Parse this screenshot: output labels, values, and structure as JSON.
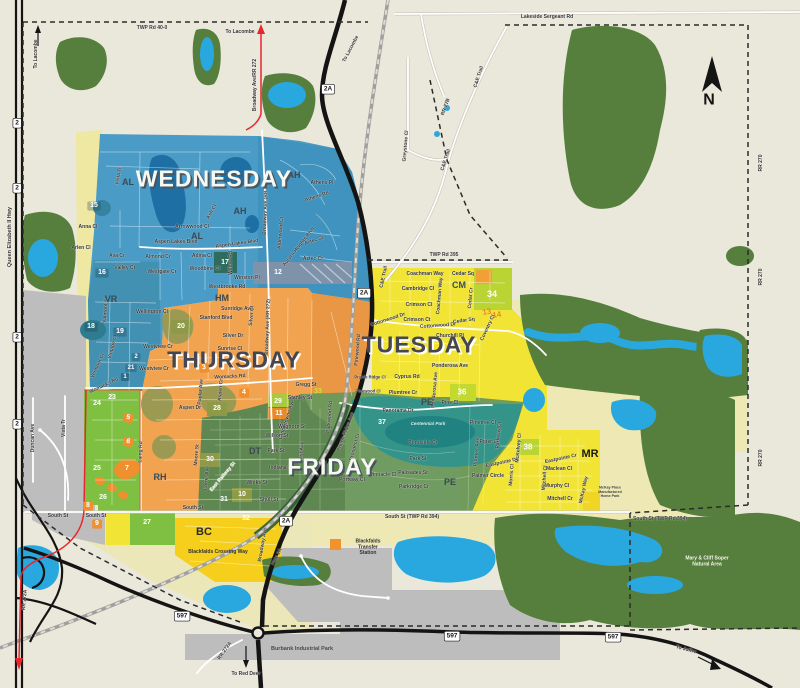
{
  "map": {
    "compass": {
      "label": "N"
    },
    "zone_colors": {
      "background": "#eae7db",
      "wednesday": "#4a9cc6",
      "wednesday_dark": "#3e92bd",
      "thursday": "#f1a350",
      "tuesday": "#f2e434",
      "friday": "#6a985c",
      "friday_dark": "#5a8450",
      "monday_lime": "#7fc043",
      "pale_yellow": "#eee9b4",
      "forest": "#567e3c",
      "water": "#29a8df",
      "gray": "#bdbdbd",
      "park_teal": "#2e948e"
    },
    "days": [
      {
        "t": "WEDNESDAY",
        "x": 214,
        "y": 179,
        "s": 23,
        "c": "#f8f8f2",
        "sh": "#4a5560",
        "fw": 800
      },
      {
        "t": "THURSDAY",
        "x": 234,
        "y": 360,
        "s": 23,
        "c": "#45464f",
        "sh": "#ffffff",
        "fw": 800
      },
      {
        "t": "TUESDAY",
        "x": 419,
        "y": 345,
        "s": 23,
        "c": "#45464f",
        "sh": "#ffffff",
        "fw": 800
      },
      {
        "t": "FRIDAY",
        "x": 332,
        "y": 467,
        "s": 23,
        "c": "#f8f8f2",
        "sh": "#4a5560",
        "fw": 800
      }
    ],
    "areas": [
      {
        "t": "AL",
        "x": 128,
        "y": 183
      },
      {
        "t": "AL",
        "x": 197,
        "y": 237
      },
      {
        "t": "AH",
        "x": 294,
        "y": 176
      },
      {
        "t": "AH",
        "x": 240,
        "y": 212
      },
      {
        "t": "VR",
        "x": 111,
        "y": 300
      },
      {
        "t": "HM",
        "x": 222,
        "y": 299
      },
      {
        "t": "RH",
        "x": 160,
        "y": 478
      },
      {
        "t": "DT",
        "x": 255,
        "y": 452
      },
      {
        "t": "PE",
        "x": 427,
        "y": 403
      },
      {
        "t": "PE",
        "x": 450,
        "y": 483
      },
      {
        "t": "CM",
        "x": 459,
        "y": 286
      },
      {
        "t": "MR",
        "x": 590,
        "y": 455,
        "s": 11,
        "c": "#1a1a1a"
      },
      {
        "t": "BC",
        "x": 204,
        "y": 533,
        "s": 11,
        "c": "#2a2a2a"
      }
    ],
    "shields": [
      {
        "t": "2",
        "x": 17,
        "y": 123
      },
      {
        "t": "2",
        "x": 17,
        "y": 188
      },
      {
        "t": "2",
        "x": 17,
        "y": 337
      },
      {
        "t": "2",
        "x": 17,
        "y": 424
      },
      {
        "t": "2A",
        "x": 328,
        "y": 89
      },
      {
        "t": "2A",
        "x": 364,
        "y": 293
      },
      {
        "t": "2A",
        "x": 286,
        "y": 521
      },
      {
        "t": "597",
        "x": 182,
        "y": 616
      },
      {
        "t": "597",
        "x": 452,
        "y": 636
      },
      {
        "t": "597",
        "x": 613,
        "y": 637
      }
    ],
    "badges": [
      {
        "t": "12",
        "x": 278,
        "y": 273
      },
      {
        "t": "15",
        "x": 94,
        "y": 206,
        "b": "rgba(22,62,84,0.30)"
      },
      {
        "t": "16",
        "x": 102,
        "y": 273,
        "b": "rgba(22,62,84,0.30)"
      },
      {
        "t": "17",
        "x": 225,
        "y": 263
      },
      {
        "t": "18",
        "x": 91,
        "y": 327,
        "b": "rgba(22,62,84,0.30)"
      },
      {
        "t": "19",
        "x": 120,
        "y": 332,
        "b": "rgba(22,62,84,0.30)"
      },
      {
        "t": "20",
        "x": 181,
        "y": 327
      },
      {
        "t": "1",
        "x": 125,
        "y": 377,
        "b": "rgba(22,62,84,0.45)",
        "s": 6
      },
      {
        "t": "2",
        "x": 136,
        "y": 357,
        "b": "rgba(22,62,84,0.30)",
        "s": 6
      },
      {
        "t": "21",
        "x": 131,
        "y": 368,
        "b": "rgba(22,62,84,0.30)",
        "s": 6
      },
      {
        "t": "3",
        "x": 204,
        "y": 368,
        "b": "#ef8f2d",
        "r": -8
      },
      {
        "t": "4",
        "x": 244,
        "y": 393,
        "b": "#ef8f2d"
      },
      {
        "t": "5",
        "x": 128,
        "y": 418,
        "b": "#ef8f2d",
        "r": 14
      },
      {
        "t": "6",
        "x": 128,
        "y": 442,
        "b": "#ef8f2d",
        "r": 14
      },
      {
        "t": "7",
        "x": 127,
        "y": 469
      },
      {
        "t": "8",
        "x": 88,
        "y": 506,
        "b": "#ef8f2d"
      },
      {
        "t": "9",
        "x": 97,
        "y": 524,
        "b": "#ef8f2d"
      },
      {
        "t": "10",
        "x": 242,
        "y": 495
      },
      {
        "t": "11",
        "x": 279,
        "y": 414
      },
      {
        "t": "13",
        "x": 487,
        "y": 313,
        "c": "#e8872e",
        "r": -10,
        "s": 8
      },
      {
        "t": "14",
        "x": 497,
        "y": 316,
        "c": "#e8872e",
        "r": -10,
        "s": 8
      },
      {
        "t": "23",
        "x": 112,
        "y": 398
      },
      {
        "t": "24",
        "x": 97,
        "y": 404
      },
      {
        "t": "25",
        "x": 97,
        "y": 469
      },
      {
        "t": "26",
        "x": 103,
        "y": 498
      },
      {
        "t": "27",
        "x": 147,
        "y": 523
      },
      {
        "t": "28",
        "x": 217,
        "y": 409
      },
      {
        "t": "29",
        "x": 278,
        "y": 402
      },
      {
        "t": "30",
        "x": 210,
        "y": 460
      },
      {
        "t": "31",
        "x": 224,
        "y": 500
      },
      {
        "t": "32",
        "x": 246,
        "y": 519
      },
      {
        "t": "33",
        "x": 318,
        "y": 392,
        "c": "#cde23f"
      },
      {
        "t": "34",
        "x": 492,
        "y": 295,
        "s": 9
      },
      {
        "t": "36",
        "x": 462,
        "y": 393,
        "s": 8
      },
      {
        "t": "37",
        "x": 382,
        "y": 423
      },
      {
        "t": "38",
        "x": 528,
        "y": 448,
        "s": 8
      }
    ],
    "roads": [
      {
        "t": "TWP Rd 40-0",
        "x": 152,
        "y": 28
      },
      {
        "t": "Lakeside Sergeant Rd",
        "x": 547,
        "y": 17
      },
      {
        "t": "To Lacombe",
        "x": 36,
        "y": 54,
        "r": -90,
        "fw": 700
      },
      {
        "t": "To Lacombe",
        "x": 240,
        "y": 32,
        "fw": 700
      },
      {
        "t": "To Lacombe",
        "x": 351,
        "y": 49,
        "r": -62,
        "fw": 700
      },
      {
        "t": "Broadway Ave/RR 272",
        "x": 255,
        "y": 85,
        "r": -90
      },
      {
        "t": "Queen Elizabeth II Hwy",
        "x": 10,
        "y": 237,
        "r": -90,
        "s": 5.5
      },
      {
        "t": "RR 270",
        "x": 761,
        "y": 163,
        "r": -90
      },
      {
        "t": "RR 270",
        "x": 761,
        "y": 277,
        "r": -90
      },
      {
        "t": "RR 270",
        "x": 761,
        "y": 458,
        "r": -90
      },
      {
        "t": "RR 27B",
        "x": 446,
        "y": 107,
        "r": -70
      },
      {
        "t": "Greystone Cl",
        "x": 406,
        "y": 146,
        "r": -85
      },
      {
        "t": "C&E Trail",
        "x": 479,
        "y": 77,
        "r": -72
      },
      {
        "t": "C&E Trail",
        "x": 446,
        "y": 160,
        "r": -72
      },
      {
        "t": "C&E Trail",
        "x": 384,
        "y": 277,
        "r": -78
      },
      {
        "t": "TWP Rd 395",
        "x": 444,
        "y": 255
      },
      {
        "t": "South St (TWP Rd 394)",
        "x": 412,
        "y": 517
      },
      {
        "t": "South St (TWP Rd 394)",
        "x": 660,
        "y": 519
      },
      {
        "t": "South St",
        "x": 58,
        "y": 516
      },
      {
        "t": "South St",
        "x": 96,
        "y": 516
      },
      {
        "t": "South St",
        "x": 193,
        "y": 508
      },
      {
        "t": "Womacks Rd",
        "x": 230,
        "y": 377,
        "r": -3
      },
      {
        "t": "Womacks Rd",
        "x": 104,
        "y": 386,
        "r": -25
      },
      {
        "t": "Duncan Ave",
        "x": 33,
        "y": 438,
        "r": -90
      },
      {
        "t": "Vista Tr",
        "x": 64,
        "y": 428,
        "r": -90
      },
      {
        "t": "Vista Tr",
        "x": 119,
        "y": 176,
        "r": -80
      },
      {
        "t": "Anna Cl",
        "x": 88,
        "y": 227
      },
      {
        "t": "Arlen Cl",
        "x": 81,
        "y": 248
      },
      {
        "t": "Ava Cr",
        "x": 117,
        "y": 256
      },
      {
        "t": "Valley Cr",
        "x": 125,
        "y": 268
      },
      {
        "t": "Aspen Lakes Blvd",
        "x": 176,
        "y": 242
      },
      {
        "t": "Aspen Lakes Blvd",
        "x": 237,
        "y": 244,
        "r": -8
      },
      {
        "t": "Almond Cr",
        "x": 158,
        "y": 257
      },
      {
        "t": "Adina Cl",
        "x": 202,
        "y": 256
      },
      {
        "t": "Arrowwood Cl",
        "x": 192,
        "y": 227
      },
      {
        "t": "Ash Cl",
        "x": 212,
        "y": 212,
        "r": -60
      },
      {
        "t": "Woodbine Cl",
        "x": 205,
        "y": 269
      },
      {
        "t": "Willow Rd",
        "x": 231,
        "y": 263,
        "r": -90
      },
      {
        "t": "Winston Pl",
        "x": 247,
        "y": 278
      },
      {
        "t": "Westbrooke Rd",
        "x": 227,
        "y": 287
      },
      {
        "t": "Westgate Cr",
        "x": 162,
        "y": 272
      },
      {
        "t": "Athens Pl",
        "x": 322,
        "y": 183
      },
      {
        "t": "Athens Rd",
        "x": 317,
        "y": 197,
        "r": -18
      },
      {
        "t": "Aztec St",
        "x": 314,
        "y": 241,
        "r": -18
      },
      {
        "t": "Aztec Cr",
        "x": 313,
        "y": 259
      },
      {
        "t": "Alderwood Cl",
        "x": 281,
        "y": 233,
        "r": -85
      },
      {
        "t": "Aurora Heights Blvd",
        "x": 299,
        "y": 247,
        "r": -52
      },
      {
        "t": "Broadway Ave (RR 272)",
        "x": 266,
        "y": 207,
        "r": -88
      },
      {
        "t": "Broadway Ave (RR 272)",
        "x": 268,
        "y": 327,
        "r": -88
      },
      {
        "t": "Wellington Cl",
        "x": 152,
        "y": 312
      },
      {
        "t": "Sunridge Ave",
        "x": 237,
        "y": 309
      },
      {
        "t": "Stanford Blvd",
        "x": 216,
        "y": 318
      },
      {
        "t": "Silver Dr",
        "x": 233,
        "y": 336
      },
      {
        "t": "Silver Cl",
        "x": 252,
        "y": 316,
        "r": -85
      },
      {
        "t": "Sunrise Cl",
        "x": 230,
        "y": 349
      },
      {
        "t": "Westview Cr",
        "x": 158,
        "y": 347
      },
      {
        "t": "Westview Cr",
        "x": 154,
        "y": 369
      },
      {
        "t": "Vintage Cl",
        "x": 113,
        "y": 347,
        "r": -75
      },
      {
        "t": "Vermont Cl",
        "x": 98,
        "y": 366,
        "r": -65
      },
      {
        "t": "Valmont St",
        "x": 106,
        "y": 310,
        "r": -85
      },
      {
        "t": "Gregg St",
        "x": 306,
        "y": 385
      },
      {
        "t": "Stanley St",
        "x": 300,
        "y": 398
      },
      {
        "t": "Aspen Dr",
        "x": 190,
        "y": 408
      },
      {
        "t": "Poplar Ave",
        "x": 201,
        "y": 392,
        "r": -85
      },
      {
        "t": "Aspen Cr",
        "x": 221,
        "y": 390,
        "r": -85
      },
      {
        "t": "Landsdowne Ave",
        "x": 287,
        "y": 420,
        "r": -72
      },
      {
        "t": "Laing Rd",
        "x": 141,
        "y": 452,
        "r": -88
      },
      {
        "t": "East Railway St",
        "x": 223,
        "y": 477,
        "r": -50,
        "c": "#eef2e4"
      },
      {
        "t": "Waghorn St",
        "x": 292,
        "y": 427
      },
      {
        "t": "Wilson St",
        "x": 277,
        "y": 436
      },
      {
        "t": "Park St",
        "x": 276,
        "y": 451
      },
      {
        "t": "Indiana St",
        "x": 281,
        "y": 468
      },
      {
        "t": "Winks St",
        "x": 257,
        "y": 483
      },
      {
        "t": "Shull St",
        "x": 269,
        "y": 500
      },
      {
        "t": "East Ave",
        "x": 302,
        "y": 452,
        "r": -85
      },
      {
        "t": "Lorne Ave",
        "x": 207,
        "y": 478,
        "r": -85
      },
      {
        "t": "Moore St",
        "x": 197,
        "y": 455,
        "r": -85
      },
      {
        "t": "Broadway Ave",
        "x": 263,
        "y": 545,
        "r": -80
      },
      {
        "t": "Hwy 2A",
        "x": 277,
        "y": 557,
        "r": -62
      },
      {
        "t": "Panorama Dr",
        "x": 398,
        "y": 411
      },
      {
        "t": "Pondside Cr",
        "x": 423,
        "y": 443
      },
      {
        "t": "Park St",
        "x": 418,
        "y": 459
      },
      {
        "t": "Palisades St",
        "x": 413,
        "y": 473
      },
      {
        "t": "Parkridge Cr",
        "x": 414,
        "y": 487
      },
      {
        "t": "Pinnacle Cl",
        "x": 383,
        "y": 475
      },
      {
        "t": "Portway Cl",
        "x": 352,
        "y": 480
      },
      {
        "t": "Prospect Cr",
        "x": 355,
        "y": 447,
        "r": -75
      },
      {
        "t": "Prairie Ridge Ave",
        "x": 346,
        "y": 432,
        "r": -70
      },
      {
        "t": "Parkwood Rd",
        "x": 330,
        "y": 417,
        "r": -85
      },
      {
        "t": "Pinewood Rd",
        "x": 358,
        "y": 350,
        "r": -85
      },
      {
        "t": "Prairie Ridge Cl",
        "x": 370,
        "y": 378,
        "s": 4.2
      },
      {
        "t": "Pinewood Cl",
        "x": 368,
        "y": 392,
        "s": 4.2
      },
      {
        "t": "Plumtree Cr",
        "x": 403,
        "y": 393
      },
      {
        "t": "Cyprus Rd",
        "x": 407,
        "y": 377
      },
      {
        "t": "Ponderosa Ave",
        "x": 450,
        "y": 366
      },
      {
        "t": "Ponderosa Ave",
        "x": 435,
        "y": 390,
        "r": -85
      },
      {
        "t": "Pine Cl",
        "x": 450,
        "y": 403
      },
      {
        "t": "Churchill Pl",
        "x": 450,
        "y": 336
      },
      {
        "t": "Cottonwood Dr",
        "x": 438,
        "y": 326,
        "r": -4
      },
      {
        "t": "Cottonwood Dr",
        "x": 388,
        "y": 320,
        "r": -18
      },
      {
        "t": "Coachman Way",
        "x": 425,
        "y": 274
      },
      {
        "t": "Coachman Way",
        "x": 440,
        "y": 296,
        "r": -85
      },
      {
        "t": "Cedar Sq",
        "x": 463,
        "y": 274
      },
      {
        "t": "Cedar Sq",
        "x": 464,
        "y": 321,
        "r": -8
      },
      {
        "t": "Cedar Cr",
        "x": 471,
        "y": 298,
        "r": -85
      },
      {
        "t": "Cambridge Cl",
        "x": 418,
        "y": 289
      },
      {
        "t": "Crimson Cl",
        "x": 419,
        "y": 305
      },
      {
        "t": "Crimson Ct",
        "x": 417,
        "y": 320
      },
      {
        "t": "Coventry Cl",
        "x": 488,
        "y": 328,
        "r": -65
      },
      {
        "t": "Pinetree Cl",
        "x": 483,
        "y": 423
      },
      {
        "t": "Piper Cl",
        "x": 489,
        "y": 442
      },
      {
        "t": "Pioneer Ave",
        "x": 477,
        "y": 452,
        "r": -85
      },
      {
        "t": "Parkway Dr",
        "x": 499,
        "y": 435,
        "r": -85
      },
      {
        "t": "Eastpointe Dr",
        "x": 502,
        "y": 463,
        "r": -12
      },
      {
        "t": "Eastpointe Cr",
        "x": 561,
        "y": 459,
        "r": -12
      },
      {
        "t": "Palmer Circle",
        "x": 488,
        "y": 476
      },
      {
        "t": "Maclean Cl",
        "x": 559,
        "y": 469
      },
      {
        "t": "Murphy Cl",
        "x": 557,
        "y": 486
      },
      {
        "t": "Mitchell Cr",
        "x": 560,
        "y": 499
      },
      {
        "t": "Mitchell Cl",
        "x": 545,
        "y": 478,
        "r": -85
      },
      {
        "t": "Morris Cl",
        "x": 512,
        "y": 475,
        "r": -85
      },
      {
        "t": "McKelvey Cl",
        "x": 519,
        "y": 448,
        "r": -85
      },
      {
        "t": "McKay Way",
        "x": 584,
        "y": 490,
        "r": -78
      },
      {
        "t": "RR 272A",
        "x": 225,
        "y": 651,
        "r": -55
      },
      {
        "t": "RR 272A",
        "x": 25,
        "y": 600,
        "r": -85
      },
      {
        "t": "To Red Deer",
        "x": 246,
        "y": 674,
        "fw": 700
      },
      {
        "t": "To Joffre",
        "x": 686,
        "y": 650,
        "r": 15,
        "fw": 700
      }
    ],
    "pois": [
      {
        "t": "Blackfalds\nTransfer\nStation",
        "x": 368,
        "y": 547,
        "s": 5,
        "c": "#333333",
        "ws": true,
        "fw": 700
      },
      {
        "t": "Mary & Cliff Soper\nNatural Area",
        "x": 707,
        "y": 561,
        "s": 5,
        "c": "#f2f4ea",
        "ws": true,
        "fw": 700
      },
      {
        "t": "Burbank Industrial Park",
        "x": 302,
        "y": 649,
        "s": 5.5,
        "c": "#4a4a4a",
        "fw": 700
      },
      {
        "t": "Blackfalds Crossing Way",
        "x": 218,
        "y": 552,
        "s": 5,
        "c": "#333333",
        "fw": 700
      },
      {
        "t": "McKay Place\nManufactured\nHome Park",
        "x": 610,
        "y": 492,
        "s": 3.6,
        "c": "#444444",
        "ws": true,
        "fw": 700
      },
      {
        "t": "Centennial Park",
        "x": 428,
        "y": 424,
        "s": 4.6,
        "c": "#d8ece2",
        "it": true,
        "fw": 700
      }
    ]
  }
}
